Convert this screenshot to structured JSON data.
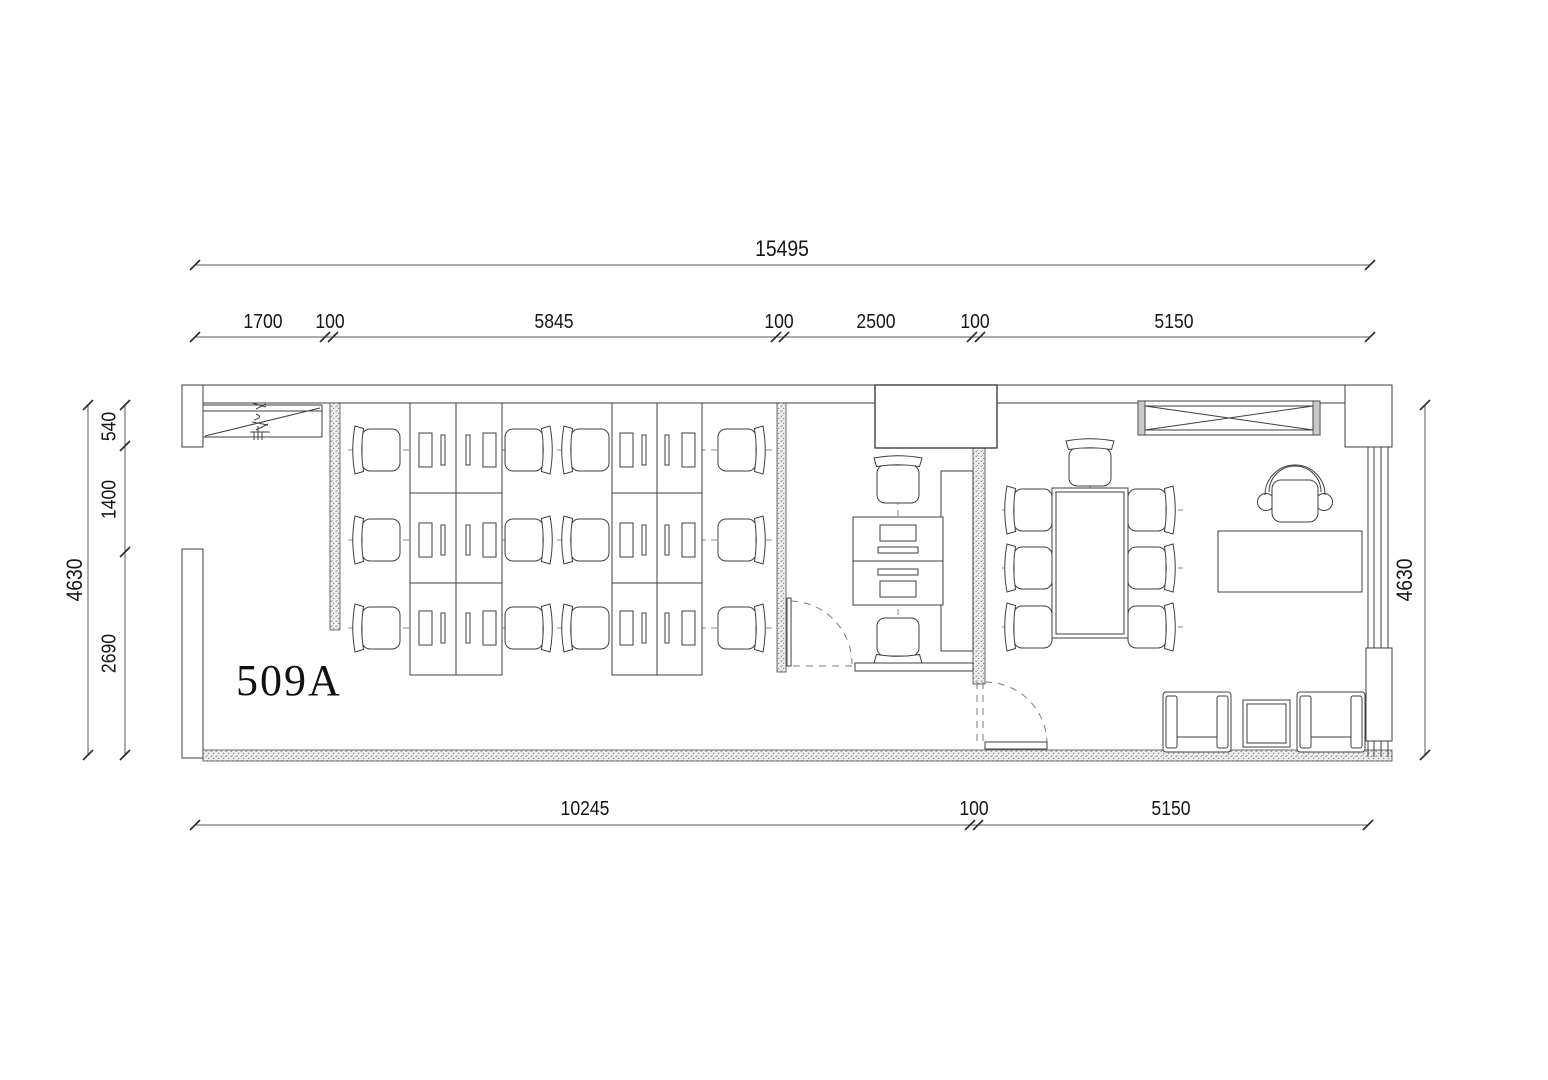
{
  "room": {
    "label": "509A"
  },
  "dimensions": {
    "top_total": "15495",
    "top_segments": [
      "1700",
      "100",
      "5845",
      "100",
      "2500",
      "100",
      "5150"
    ],
    "bottom_segments": [
      "10245",
      "100",
      "5150"
    ],
    "left_total": "4630",
    "left_segments": [
      "540",
      "1400",
      "2690"
    ],
    "right_total": "4630"
  },
  "furniture": [
    {
      "name": "workstation-desk-bank",
      "count": 2
    },
    {
      "name": "workstation-chair",
      "count": 12
    },
    {
      "name": "reception-desk-pair",
      "count": 1
    },
    {
      "name": "conference-table",
      "count": 1
    },
    {
      "name": "conference-chair",
      "count": 7
    },
    {
      "name": "executive-desk",
      "count": 1
    },
    {
      "name": "executive-chair",
      "count": 1
    },
    {
      "name": "armchair",
      "count": 2
    },
    {
      "name": "side-table",
      "count": 1
    },
    {
      "name": "wardrobe-crossed-cabinet",
      "count": 1
    },
    {
      "name": "entry-cabinet",
      "count": 1
    }
  ],
  "colors": {
    "background": "#ffffff",
    "line": "#3f3f3f",
    "hatch": "#8f8f8f",
    "dash": "#8a8a8a"
  }
}
